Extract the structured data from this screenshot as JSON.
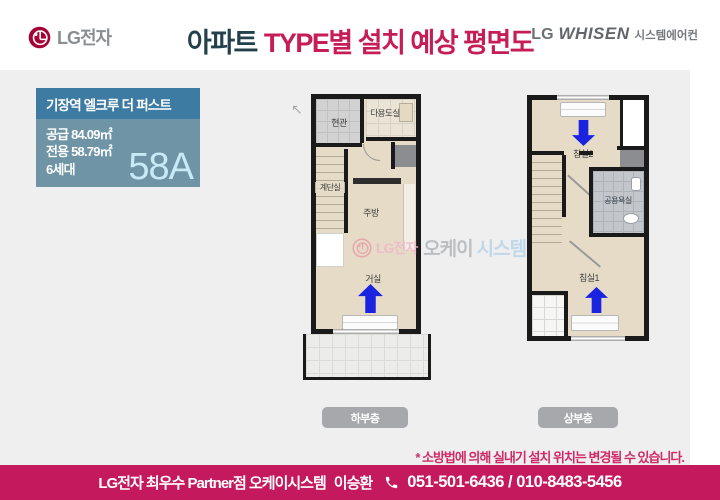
{
  "header": {
    "logo_text": "LG전자",
    "title": {
      "part1": "아파트",
      "part2": "TYPE별 설치 예상 평면도"
    },
    "whisen": {
      "lg": "LG",
      "brand": "WHISEN",
      "suffix": "시스템에어컨"
    }
  },
  "info_box": {
    "title": "기장역 엘크루 더 퍼스트",
    "line1": "공급 84.09㎡",
    "line2": "전용 58.79㎡",
    "line3": "6세대",
    "type_code": "58A"
  },
  "plans": {
    "lower": {
      "button": "하부층",
      "rooms": {
        "entrance": "현관",
        "utility": "다용도실",
        "stairwell": "계단실",
        "kitchen": "주방",
        "living": "거실"
      }
    },
    "upper": {
      "button": "상부층",
      "rooms": {
        "bedroom2": "침실2",
        "bathroom": "공용욕실",
        "bedroom1": "침실1"
      }
    }
  },
  "watermark": {
    "lg": "LG전자",
    "part1": "오케이",
    "part2": "시스템"
  },
  "note": "* 소방법에 의해 실내기 설치 위치는 변경될 수 있습니다.",
  "footer": {
    "dealer": "LG전자 최우수 Partner점 오케이시스템",
    "name": "이승환",
    "phone": "051-501-6436 / 010-8483-5456"
  },
  "colors": {
    "title_accent": "#c61d57",
    "title_dark": "#23404d",
    "footer_bg": "#c4195c",
    "info_header_bg": "#3d7ba3",
    "info_body_bg": "#6e94a6",
    "type_code_text": "#c8e9f6",
    "arrow_blue": "#1a24e0",
    "lg_brand": "#a50034",
    "content_bg": "#efeff0"
  }
}
